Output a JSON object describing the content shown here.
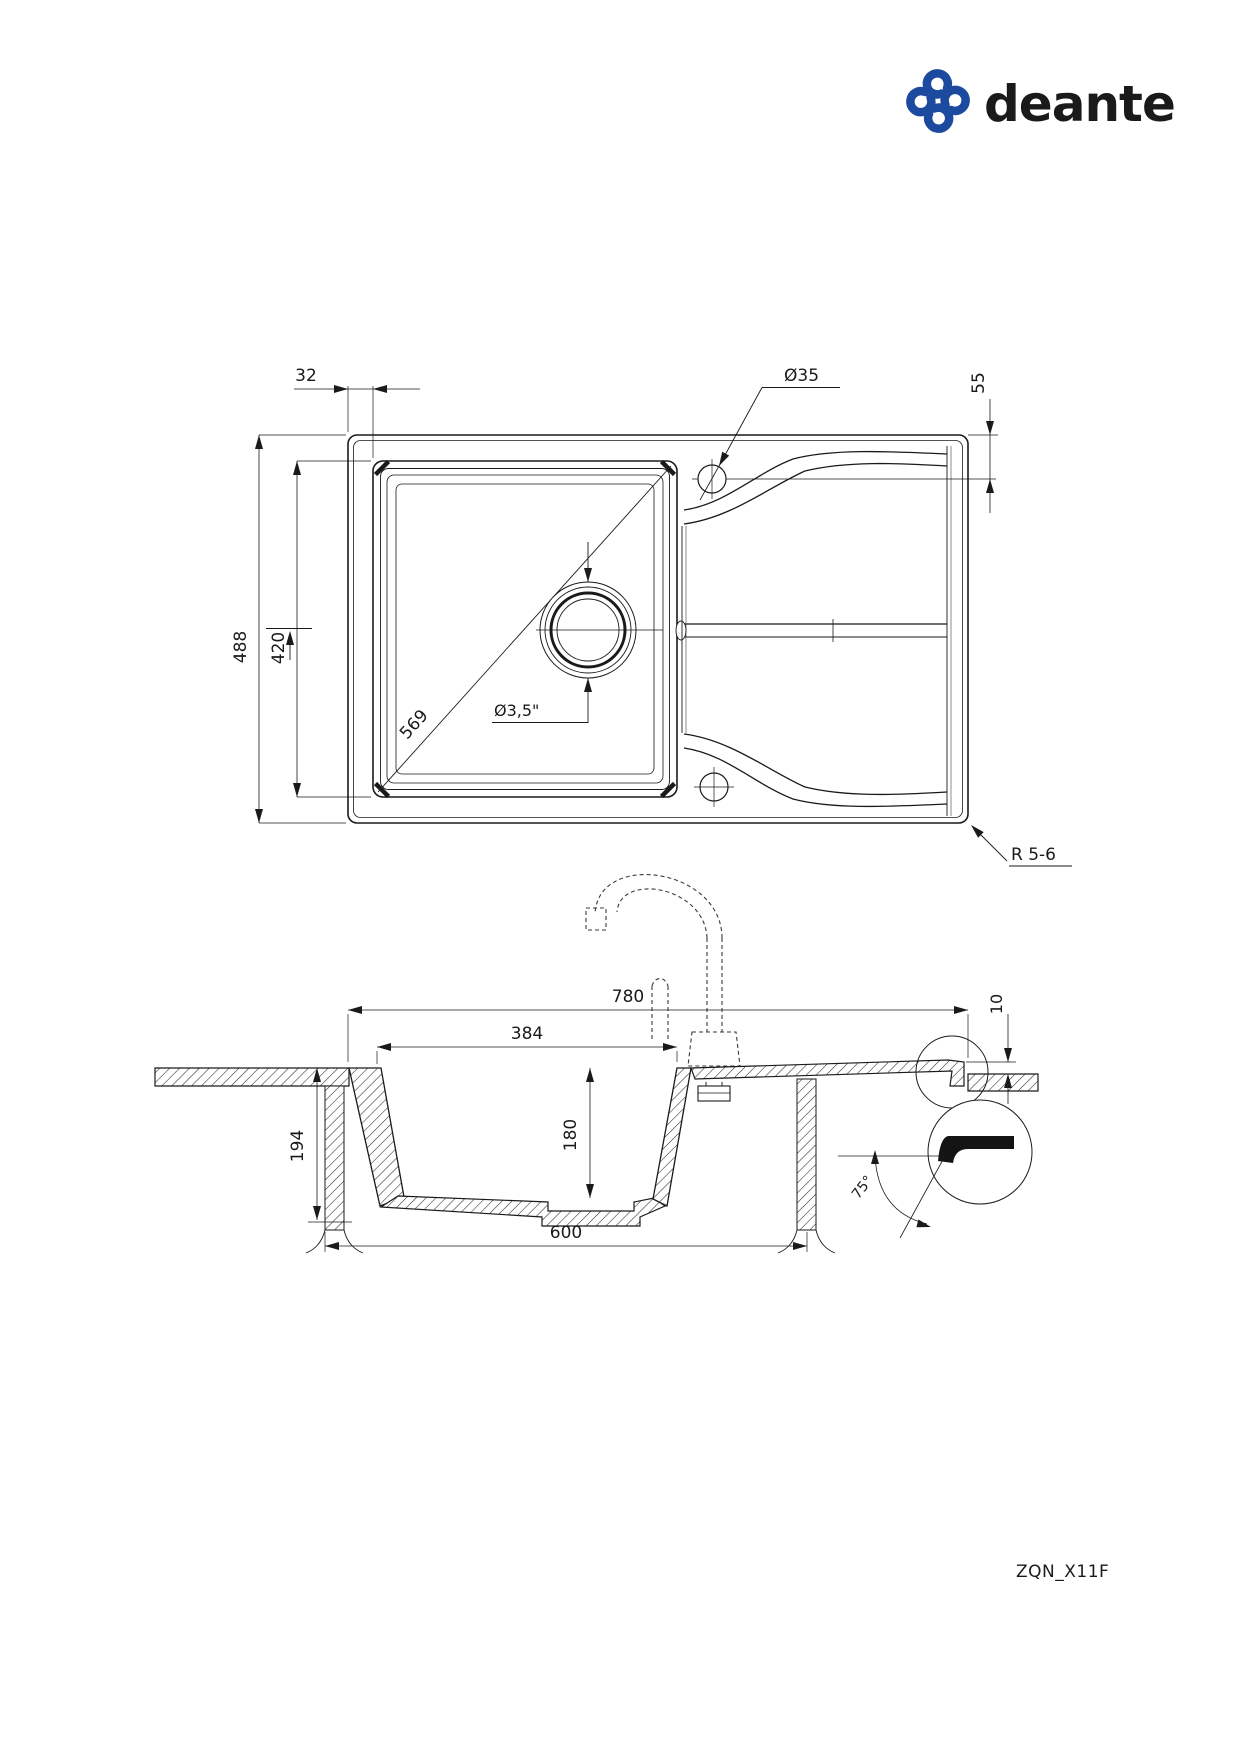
{
  "page": {
    "background": "#ffffff",
    "line_color": "#1a1a1a",
    "accent_color": "#1b4a9e"
  },
  "brand": {
    "name": "deante",
    "icon": "pinwheel-logo-icon"
  },
  "drawing_code": "ZQN_X11F",
  "top_view": {
    "dim_edge_offset": "32",
    "dim_tap_hole_diameter": "Ø35",
    "dim_tap_hole_offset": "55",
    "dim_overall_depth": "488",
    "dim_bowl_depth": "420",
    "dim_bowl_diagonal": "569",
    "dim_drain_diameter": "Ø3,5\"",
    "dim_corner_radius": "R 5-6"
  },
  "section_view": {
    "dim_overall_width": "780",
    "dim_bowl_width": "384",
    "dim_edge_thickness": "10",
    "dim_overall_height": "194",
    "dim_bowl_height": "180",
    "dim_cabinet_width": "600",
    "dim_edge_angle": "75°"
  }
}
